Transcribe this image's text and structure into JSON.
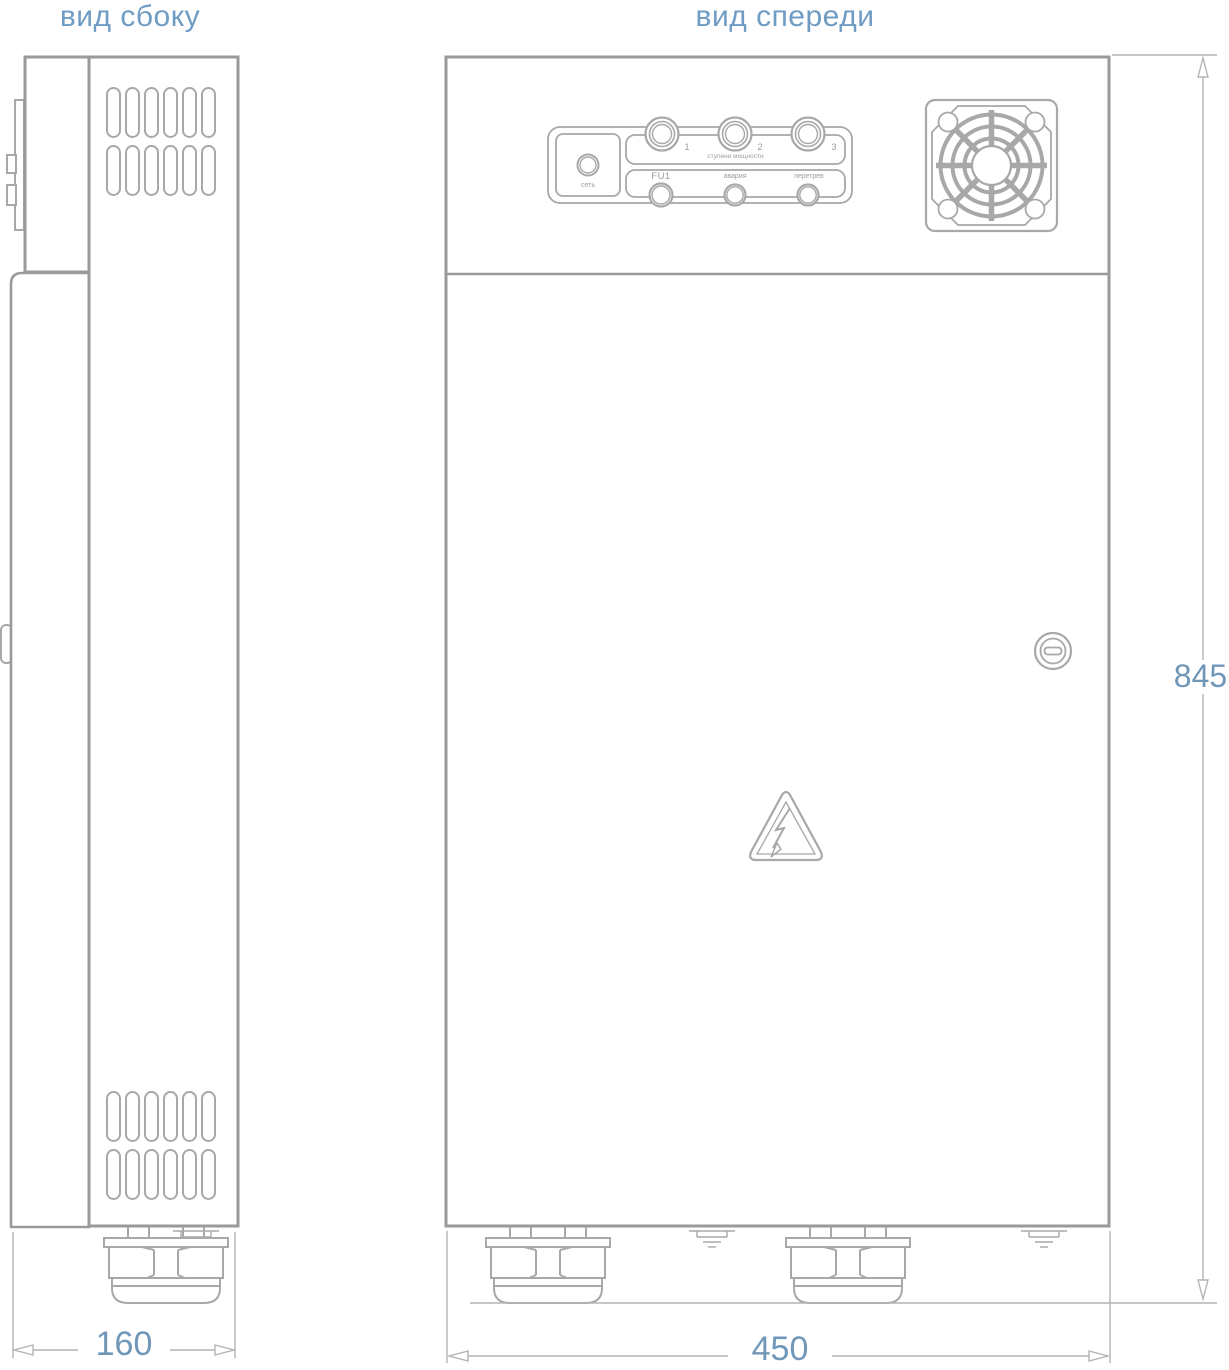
{
  "drawing": {
    "side_view_title": "вид сбоку",
    "front_view_title": "вид спереди",
    "dimensions": {
      "side_depth_mm": "160",
      "front_width_mm": "450",
      "height_mm": "845"
    },
    "control_panel": {
      "power_indicator_label": "сеть",
      "power_stages_label": "ступени мощности",
      "stage_labels": [
        "1",
        "2",
        "3"
      ],
      "fuse_label": "FU1",
      "alarm_label": "авария",
      "overheat_label": "перегрев"
    },
    "colors": {
      "accent_blue": "#6f9cc4",
      "dimension_blue": "#7097b8",
      "outline_gray": "#9a9a9a",
      "detail_gray": "#a8a8a8",
      "dimension_line_gray": "#b4b4b4"
    }
  }
}
